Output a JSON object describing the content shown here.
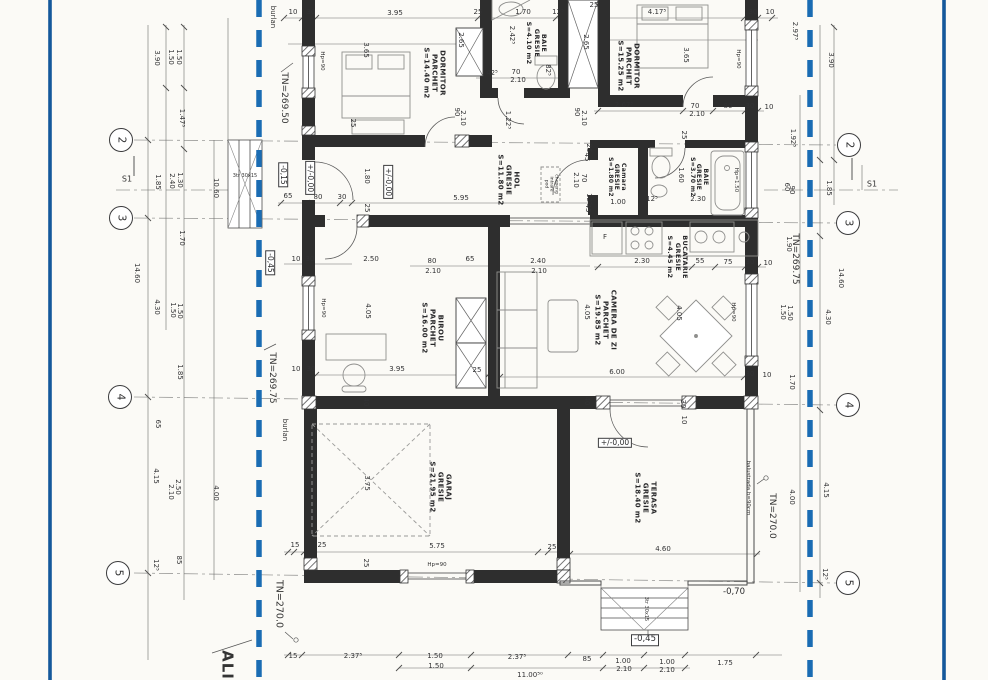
{
  "drawing": {
    "type": "architectural floor plan (scanned)",
    "boundary_color": "#1666ab",
    "ink_color": "#2f2f30"
  },
  "grid_markers": [
    {
      "n": "2",
      "x": 121,
      "y": 140
    },
    {
      "n": "3",
      "x": 121,
      "y": 218
    },
    {
      "n": "4",
      "x": 120,
      "y": 397
    },
    {
      "n": "5",
      "x": 118,
      "y": 573
    },
    {
      "n": "2",
      "x": 849,
      "y": 145
    },
    {
      "n": "3",
      "x": 848,
      "y": 223
    },
    {
      "n": "4",
      "x": 848,
      "y": 405
    },
    {
      "n": "5",
      "x": 848,
      "y": 583
    }
  ],
  "rooms": [
    {
      "t": "DORMITOR\nPARCHET\nS=14.40 m2",
      "x": 434,
      "y": 73,
      "r": 90
    },
    {
      "t": "BAIE\nGRESIE\nS=4.10 m2",
      "x": 536,
      "y": 43,
      "r": 90,
      "s": 6.5
    },
    {
      "t": "DORMITOR\nPARCHET\nS=15.25 m2",
      "x": 628,
      "y": 66,
      "r": 90
    },
    {
      "t": "HOL\nGRESIE\nS=11.80 m2",
      "x": 508,
      "y": 180,
      "r": 90
    },
    {
      "t": "Camara\nGRESIE\nS=1.80 m2",
      "x": 616,
      "y": 177,
      "r": 90,
      "s": 6
    },
    {
      "t": "BAIE\nGRESIE\nS=3.70 m2",
      "x": 698,
      "y": 177,
      "r": 90,
      "s": 6
    },
    {
      "t": "BUCATARIE\nGRESIE\nS=4.45 m2",
      "x": 677,
      "y": 257,
      "r": 90,
      "s": 6.5
    },
    {
      "t": "CAMERA DE ZI\nPARCHET\nS=19.85 m2",
      "x": 605,
      "y": 320,
      "r": 90
    },
    {
      "t": "BIROU\nPARCHET\nS=16.00 m2",
      "x": 432,
      "y": 328,
      "r": 90
    },
    {
      "t": "GARAJ\nGRESIE\nS=21.95 m2",
      "x": 440,
      "y": 487,
      "r": 90
    },
    {
      "t": "TERASA\nGRESIE\nS=18.40 m2",
      "x": 645,
      "y": 498,
      "r": 90
    }
  ],
  "levels": [
    {
      "t": "-0,15",
      "x": 283,
      "y": 175,
      "r": 90,
      "box": true
    },
    {
      "t": "+/-0,00",
      "x": 310,
      "y": 178,
      "r": 90,
      "box": true
    },
    {
      "t": "+/-0,00",
      "x": 388,
      "y": 182,
      "r": 90,
      "box": true
    },
    {
      "t": "-0,45",
      "x": 270,
      "y": 263,
      "r": 90,
      "box": true
    },
    {
      "t": "+/-0,00",
      "x": 615,
      "y": 443,
      "box": true
    },
    {
      "t": "-0,70",
      "x": 734,
      "y": 593,
      "s": 8.5
    },
    {
      "t": "-0,45",
      "x": 645,
      "y": 640,
      "box": true,
      "s": 8.5
    }
  ],
  "annotations": [
    {
      "t": "burlan",
      "x": 272,
      "y": 17,
      "r": 90,
      "s": 7
    },
    {
      "t": "burlan",
      "x": 284,
      "y": 430,
      "r": 90,
      "s": 7
    },
    {
      "t": "TN=269.50",
      "x": 284,
      "y": 98,
      "r": 90,
      "s": 9
    },
    {
      "t": "TN=269.75",
      "x": 272,
      "y": 378,
      "r": 90,
      "s": 9
    },
    {
      "t": "TN=269.75",
      "x": 795,
      "y": 259,
      "r": 90,
      "s": 9
    },
    {
      "t": "TN=270.0",
      "x": 278,
      "y": 604,
      "r": 90,
      "s": 9.5
    },
    {
      "t": "TN=270.0",
      "x": 772,
      "y": 516,
      "r": 90,
      "s": 9
    },
    {
      "t": "ALI",
      "x": 227,
      "y": 665,
      "r": 90,
      "s": 15,
      "b": true
    },
    {
      "t": "S1",
      "x": 127,
      "y": 180,
      "s": 8
    },
    {
      "t": "S1",
      "x": 872,
      "y": 185,
      "s": 8
    },
    {
      "t": "balustrada h=90cm",
      "x": 748,
      "y": 488,
      "r": 90,
      "s": 5.5
    },
    {
      "t": "chepeng\nintrare\npod",
      "x": 551,
      "y": 184,
      "r": 90,
      "s": 4.5
    },
    {
      "t": "3tr 30x15",
      "x": 245,
      "y": 177,
      "s": 5
    },
    {
      "t": "3tr 30x15",
      "x": 645,
      "y": 609,
      "r": 90,
      "s": 5
    },
    {
      "t": "Hp=90",
      "x": 322,
      "y": 61,
      "r": 90,
      "s": 5.5
    },
    {
      "t": "Hp=90",
      "x": 738,
      "y": 59,
      "r": 90,
      "s": 5.5
    },
    {
      "t": "Hp=90",
      "x": 323,
      "y": 308,
      "r": 90,
      "s": 5.5
    },
    {
      "t": "Hp=90",
      "x": 733,
      "y": 312,
      "r": 90,
      "s": 5.5
    },
    {
      "t": "Hp=90",
      "x": 437,
      "y": 565,
      "s": 5.5
    },
    {
      "t": "Hp=1.50",
      "x": 736,
      "y": 180,
      "r": 90,
      "s": 5.5
    },
    {
      "t": "F",
      "x": 605,
      "y": 238,
      "s": 7
    }
  ],
  "dims": [
    {
      "t": "10",
      "x": 293,
      "y": 13
    },
    {
      "t": "30",
      "x": 311,
      "y": 13
    },
    {
      "t": "3.95",
      "x": 395,
      "y": 14
    },
    {
      "t": "25",
      "x": 478,
      "y": 13
    },
    {
      "t": "1.70",
      "x": 523,
      "y": 13
    },
    {
      "t": "12⁵",
      "x": 558,
      "y": 13
    },
    {
      "t": "4.17⁵",
      "x": 657,
      "y": 13
    },
    {
      "t": "30",
      "x": 753,
      "y": 13
    },
    {
      "t": "10",
      "x": 770,
      "y": 13
    },
    {
      "t": "25",
      "x": 594,
      "y": 6
    },
    {
      "t": "3.90",
      "x": 156,
      "y": 58,
      "r": 90
    },
    {
      "t": "1.50",
      "x": 170,
      "y": 57,
      "r": 90
    },
    {
      "t": "1.50",
      "x": 178,
      "y": 57,
      "r": 90
    },
    {
      "t": "1.47⁵",
      "x": 181,
      "y": 118,
      "r": 90
    },
    {
      "t": "1.85",
      "x": 157,
      "y": 182,
      "r": 90
    },
    {
      "t": "2.40",
      "x": 171,
      "y": 181,
      "r": 90
    },
    {
      "t": "1.30",
      "x": 179,
      "y": 180,
      "r": 90
    },
    {
      "t": "10.60",
      "x": 215,
      "y": 188,
      "r": 90
    },
    {
      "t": "1.70",
      "x": 181,
      "y": 238,
      "r": 90
    },
    {
      "t": "14.60",
      "x": 136,
      "y": 273,
      "r": 90
    },
    {
      "t": "4.30",
      "x": 156,
      "y": 307,
      "r": 90
    },
    {
      "t": "1.50",
      "x": 172,
      "y": 310,
      "r": 90
    },
    {
      "t": "1.50",
      "x": 179,
      "y": 311,
      "r": 90
    },
    {
      "t": "1.85",
      "x": 179,
      "y": 372,
      "r": 90
    },
    {
      "t": "65",
      "x": 157,
      "y": 424,
      "r": 90
    },
    {
      "t": "4.15",
      "x": 155,
      "y": 476,
      "r": 90
    },
    {
      "t": "2.50",
      "x": 177,
      "y": 487,
      "r": 90
    },
    {
      "t": "2.10",
      "x": 170,
      "y": 492,
      "r": 90
    },
    {
      "t": "4.00",
      "x": 215,
      "y": 493,
      "r": 90
    },
    {
      "t": "85",
      "x": 178,
      "y": 560,
      "r": 90
    },
    {
      "t": "12⁵",
      "x": 155,
      "y": 565,
      "r": 90
    },
    {
      "t": "2.97⁵",
      "x": 794,
      "y": 31,
      "r": 90
    },
    {
      "t": "3.90",
      "x": 830,
      "y": 60,
      "r": 90
    },
    {
      "t": "1.92⁵",
      "x": 792,
      "y": 138,
      "r": 90
    },
    {
      "t": "1.85",
      "x": 828,
      "y": 188,
      "r": 90
    },
    {
      "t": "1.90",
      "x": 788,
      "y": 244,
      "r": 90
    },
    {
      "t": "14.60",
      "x": 840,
      "y": 278,
      "r": 90
    },
    {
      "t": "4.30",
      "x": 827,
      "y": 317,
      "r": 90
    },
    {
      "t": "1.50",
      "x": 782,
      "y": 312,
      "r": 90
    },
    {
      "t": "1.50",
      "x": 789,
      "y": 313,
      "r": 90
    },
    {
      "t": "1.70",
      "x": 791,
      "y": 382,
      "r": 90
    },
    {
      "t": "4.15",
      "x": 825,
      "y": 490,
      "r": 90
    },
    {
      "t": "4.00",
      "x": 791,
      "y": 497,
      "r": 90
    },
    {
      "t": "12⁵",
      "x": 824,
      "y": 574,
      "r": 90
    },
    {
      "t": "15",
      "x": 293,
      "y": 657
    },
    {
      "t": "2.37⁵",
      "x": 353,
      "y": 657
    },
    {
      "t": "1.50",
      "x": 435,
      "y": 657
    },
    {
      "t": "1.50",
      "x": 436,
      "y": 667
    },
    {
      "t": "2.37⁵",
      "x": 517,
      "y": 658
    },
    {
      "t": "85",
      "x": 587,
      "y": 660
    },
    {
      "t": "1.00",
      "x": 623,
      "y": 662
    },
    {
      "t": "2.10",
      "x": 624,
      "y": 670
    },
    {
      "t": "1.00",
      "x": 667,
      "y": 663
    },
    {
      "t": "2.10",
      "x": 667,
      "y": 671
    },
    {
      "t": "1.75",
      "x": 725,
      "y": 664
    },
    {
      "t": "11.00⁵⁰",
      "x": 530,
      "y": 676
    },
    {
      "t": "3.65",
      "x": 365,
      "y": 50,
      "r": 90
    },
    {
      "t": "2.65",
      "x": 460,
      "y": 40,
      "r": 90
    },
    {
      "t": "25",
      "x": 352,
      "y": 123,
      "r": 90
    },
    {
      "t": "90",
      "x": 456,
      "y": 112,
      "r": 90
    },
    {
      "t": "2.10",
      "x": 462,
      "y": 118,
      "r": 90
    },
    {
      "t": "1.22⁵",
      "x": 507,
      "y": 120,
      "r": 90
    },
    {
      "t": "42⁵",
      "x": 492,
      "y": 74
    },
    {
      "t": "70",
      "x": 516,
      "y": 73
    },
    {
      "t": "2.10",
      "x": 518,
      "y": 81
    },
    {
      "t": "82⁵",
      "x": 547,
      "y": 70,
      "r": 90
    },
    {
      "t": "2.42⁵",
      "x": 511,
      "y": 35,
      "r": 90
    },
    {
      "t": "2.65",
      "x": 585,
      "y": 42,
      "r": 90
    },
    {
      "t": "90",
      "x": 576,
      "y": 112,
      "r": 90
    },
    {
      "t": "2.10",
      "x": 583,
      "y": 118,
      "r": 90
    },
    {
      "t": "3.65",
      "x": 685,
      "y": 55,
      "r": 90
    },
    {
      "t": "2.67⁵",
      "x": 624,
      "y": 106
    },
    {
      "t": "70",
      "x": 695,
      "y": 107
    },
    {
      "t": "2.10",
      "x": 697,
      "y": 115
    },
    {
      "t": "80",
      "x": 728,
      "y": 107
    },
    {
      "t": "30",
      "x": 750,
      "y": 107
    },
    {
      "t": "10",
      "x": 769,
      "y": 108
    },
    {
      "t": "65",
      "x": 288,
      "y": 197
    },
    {
      "t": "80",
      "x": 318,
      "y": 198
    },
    {
      "t": "30",
      "x": 342,
      "y": 198
    },
    {
      "t": "5.95",
      "x": 461,
      "y": 199
    },
    {
      "t": "2.10",
      "x": 575,
      "y": 180,
      "r": 90
    },
    {
      "t": "70",
      "x": 583,
      "y": 178,
      "r": 90
    },
    {
      "t": "12⁵",
      "x": 588,
      "y": 199,
      "r": 90
    },
    {
      "t": "45",
      "x": 587,
      "y": 208,
      "r": 90
    },
    {
      "t": "25",
      "x": 588,
      "y": 148,
      "r": 90
    },
    {
      "t": "45",
      "x": 586,
      "y": 157,
      "r": 90
    },
    {
      "t": "1.00",
      "x": 618,
      "y": 203
    },
    {
      "t": "12⁵",
      "x": 652,
      "y": 200
    },
    {
      "t": "1.60",
      "x": 680,
      "y": 175,
      "r": 90
    },
    {
      "t": "2.30",
      "x": 698,
      "y": 200
    },
    {
      "t": "25",
      "x": 683,
      "y": 135,
      "r": 90
    },
    {
      "t": "60",
      "x": 786,
      "y": 187,
      "r": 90
    },
    {
      "t": "90",
      "x": 791,
      "y": 190,
      "r": 90
    },
    {
      "t": "2.30",
      "x": 642,
      "y": 262
    },
    {
      "t": "55",
      "x": 700,
      "y": 262
    },
    {
      "t": "75",
      "x": 728,
      "y": 263
    },
    {
      "t": "30",
      "x": 750,
      "y": 263
    },
    {
      "t": "10",
      "x": 768,
      "y": 264
    },
    {
      "t": "10",
      "x": 296,
      "y": 260
    },
    {
      "t": "30",
      "x": 310,
      "y": 260
    },
    {
      "t": "2.50",
      "x": 371,
      "y": 260
    },
    {
      "t": "1.80",
      "x": 366,
      "y": 176,
      "r": 90
    },
    {
      "t": "80",
      "x": 432,
      "y": 262
    },
    {
      "t": "2.10",
      "x": 433,
      "y": 272
    },
    {
      "t": "65",
      "x": 470,
      "y": 260
    },
    {
      "t": "2.40",
      "x": 538,
      "y": 262
    },
    {
      "t": "2.10",
      "x": 539,
      "y": 272
    },
    {
      "t": "4.05",
      "x": 367,
      "y": 311,
      "r": 90
    },
    {
      "t": "3.95",
      "x": 397,
      "y": 370
    },
    {
      "t": "25",
      "x": 477,
      "y": 371
    },
    {
      "t": "10",
      "x": 296,
      "y": 370
    },
    {
      "t": "30",
      "x": 311,
      "y": 370
    },
    {
      "t": "40",
      "x": 365,
      "y": 402,
      "r": 90
    },
    {
      "t": "40",
      "x": 586,
      "y": 401,
      "r": 90
    },
    {
      "t": "25",
      "x": 366,
      "y": 208,
      "r": 90
    },
    {
      "t": "4.05",
      "x": 586,
      "y": 312,
      "r": 90
    },
    {
      "t": "4.05",
      "x": 678,
      "y": 313,
      "r": 90
    },
    {
      "t": "6.00",
      "x": 617,
      "y": 373
    },
    {
      "t": "30",
      "x": 682,
      "y": 404,
      "r": 90
    },
    {
      "t": "10",
      "x": 683,
      "y": 420,
      "r": 90
    },
    {
      "t": "30",
      "x": 750,
      "y": 375
    },
    {
      "t": "10",
      "x": 767,
      "y": 376
    },
    {
      "t": "3.75",
      "x": 366,
      "y": 483,
      "r": 90
    },
    {
      "t": "15",
      "x": 295,
      "y": 546
    },
    {
      "t": "25",
      "x": 322,
      "y": 546
    },
    {
      "t": "5.75",
      "x": 437,
      "y": 547
    },
    {
      "t": "25",
      "x": 552,
      "y": 548
    },
    {
      "t": "25",
      "x": 365,
      "y": 563,
      "r": 90
    },
    {
      "t": "4.60",
      "x": 663,
      "y": 550
    }
  ]
}
